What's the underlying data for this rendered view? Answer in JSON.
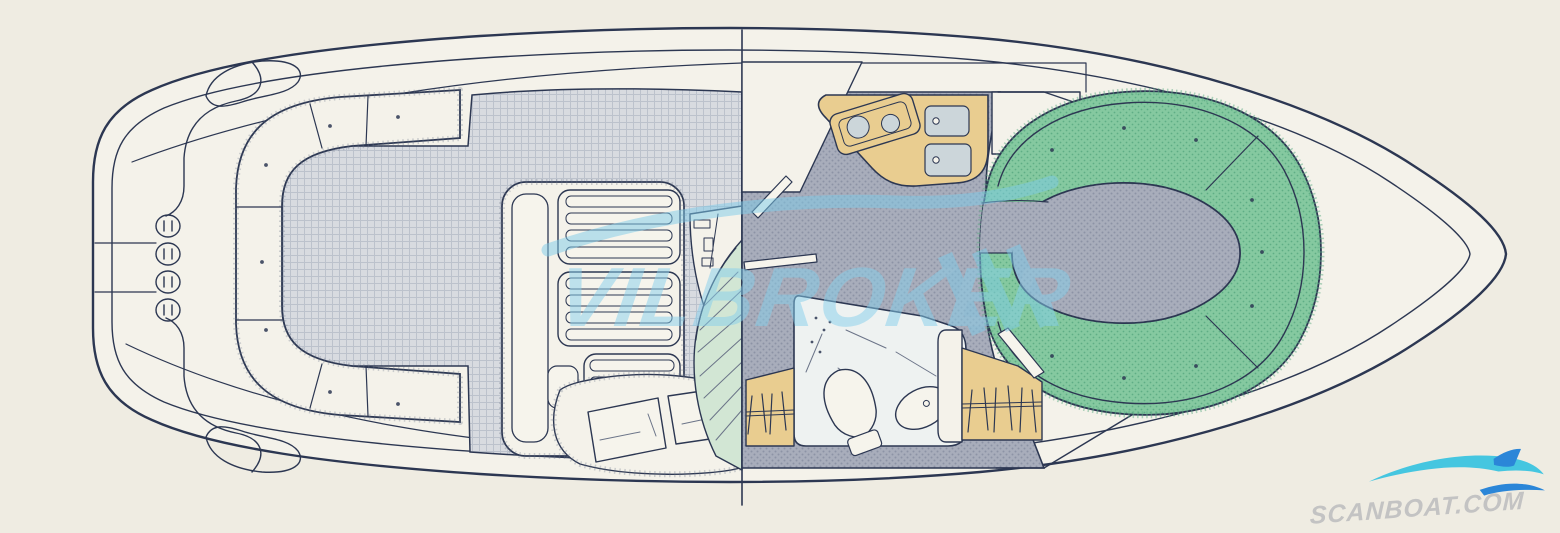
{
  "watermarks": {
    "center": {
      "text": "VILBROKER",
      "swoosh_icon": "wave-swoosh-icon",
      "slash_marks": 3,
      "color": "#7ecbe9"
    },
    "corner": {
      "text": "SCANBOAT.COM",
      "swoosh_icon": "scanboat-wave-icon",
      "text_color": "#bcbcbe",
      "wave_colors": [
        "#45c6e0",
        "#2b86d8"
      ]
    }
  },
  "palette": {
    "paper": "#efece2",
    "paper-bright": "#f4f2ea",
    "line": "#2c3752",
    "floor-base": "#d8dbe0",
    "floor-grid": "#bcc2cc",
    "interior-base": "#a8adbb",
    "interior-dot": "#8d93a5",
    "green": "#85c9a0",
    "green-dot": "#5fae85",
    "tan": "#e9cd90",
    "stair": "#d2e6d4",
    "sink": "#ccd6da",
    "head": "#eef2f1",
    "wm-blue": "#7ecbe9",
    "wm-text": "#86cfec",
    "corner-text": "#bcbcbe",
    "wave-cyan": "#45c6e0",
    "wave-blue": "#2b86d8"
  },
  "areas": [
    "hull-outline",
    "swim-platform",
    "transom",
    "cockpit-bench-seating",
    "cockpit-floor",
    "sun-pads",
    "aft-berth-pillows",
    "helm-console",
    "companionway-stairs",
    "galley",
    "stove",
    "sinks",
    "dinette-seating",
    "dinette-floor",
    "head-compartment",
    "toilet",
    "wash-basin",
    "hanging-lockers",
    "bow-cabin-walls"
  ]
}
